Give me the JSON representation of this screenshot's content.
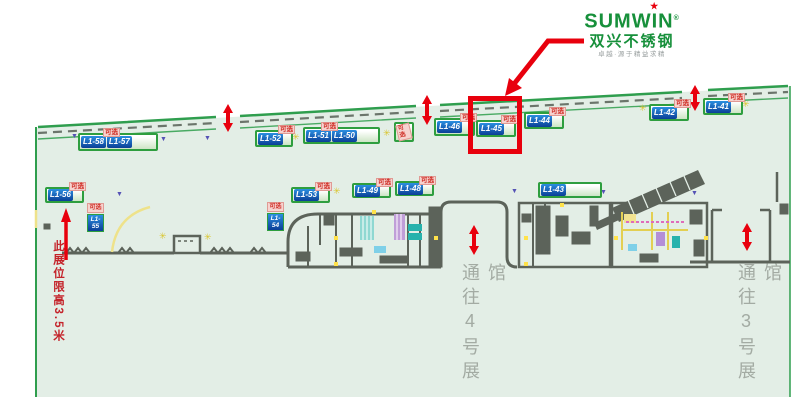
{
  "logo": {
    "brand": "SUMWIN",
    "reg": "®",
    "cn_name": "双兴不锈钢",
    "slogan": "卓越·源于精益求精"
  },
  "labels": {
    "optional": "可选"
  },
  "icons": {
    "sparkle": "✳",
    "triangle": "▼",
    "star": "★"
  },
  "booths": [
    {
      "id": "L1-58",
      "optional": true
    },
    {
      "id": "L1-57",
      "optional": false
    },
    {
      "id": "L1-52",
      "optional": true
    },
    {
      "id": "L1-51",
      "optional": true
    },
    {
      "id": "L1-50",
      "optional": false
    },
    {
      "id": "L1-46",
      "optional": true
    },
    {
      "id": "L1-45",
      "optional": true,
      "highlighted": true
    },
    {
      "id": "L1-44",
      "optional": true
    },
    {
      "id": "L1-42",
      "optional": true
    },
    {
      "id": "L1-41",
      "optional": true
    },
    {
      "id": "L1-56",
      "optional": true
    },
    {
      "id": "L1-53",
      "optional": true
    },
    {
      "id": "L1-49",
      "optional": true
    },
    {
      "id": "L1-48",
      "optional": true
    },
    {
      "id": "L1-43",
      "optional": false
    },
    {
      "id": "L1-55",
      "line1": "L1-",
      "line2": "55",
      "optional": true
    },
    {
      "id": "L1-54",
      "line1": "L1-",
      "line2": "54",
      "optional": true
    }
  ],
  "annotations": {
    "height_note": "此展位限高3.5米",
    "corridor_hall4": "通往4号展馆",
    "corridor_hall3": "通往3号展馆"
  },
  "highlight": {
    "booth": "L1-45"
  },
  "colors": {
    "accent_red": "#e8000d",
    "brand_green": "#17903b",
    "hall_mint": "#e3eee6",
    "boundary_green": "#2f9e4e",
    "booth_blue": "#1565c0",
    "tag_red": "#cf2c24",
    "wall_gray": "#5c635a",
    "corridor_text_gray": "#a3aba3"
  }
}
